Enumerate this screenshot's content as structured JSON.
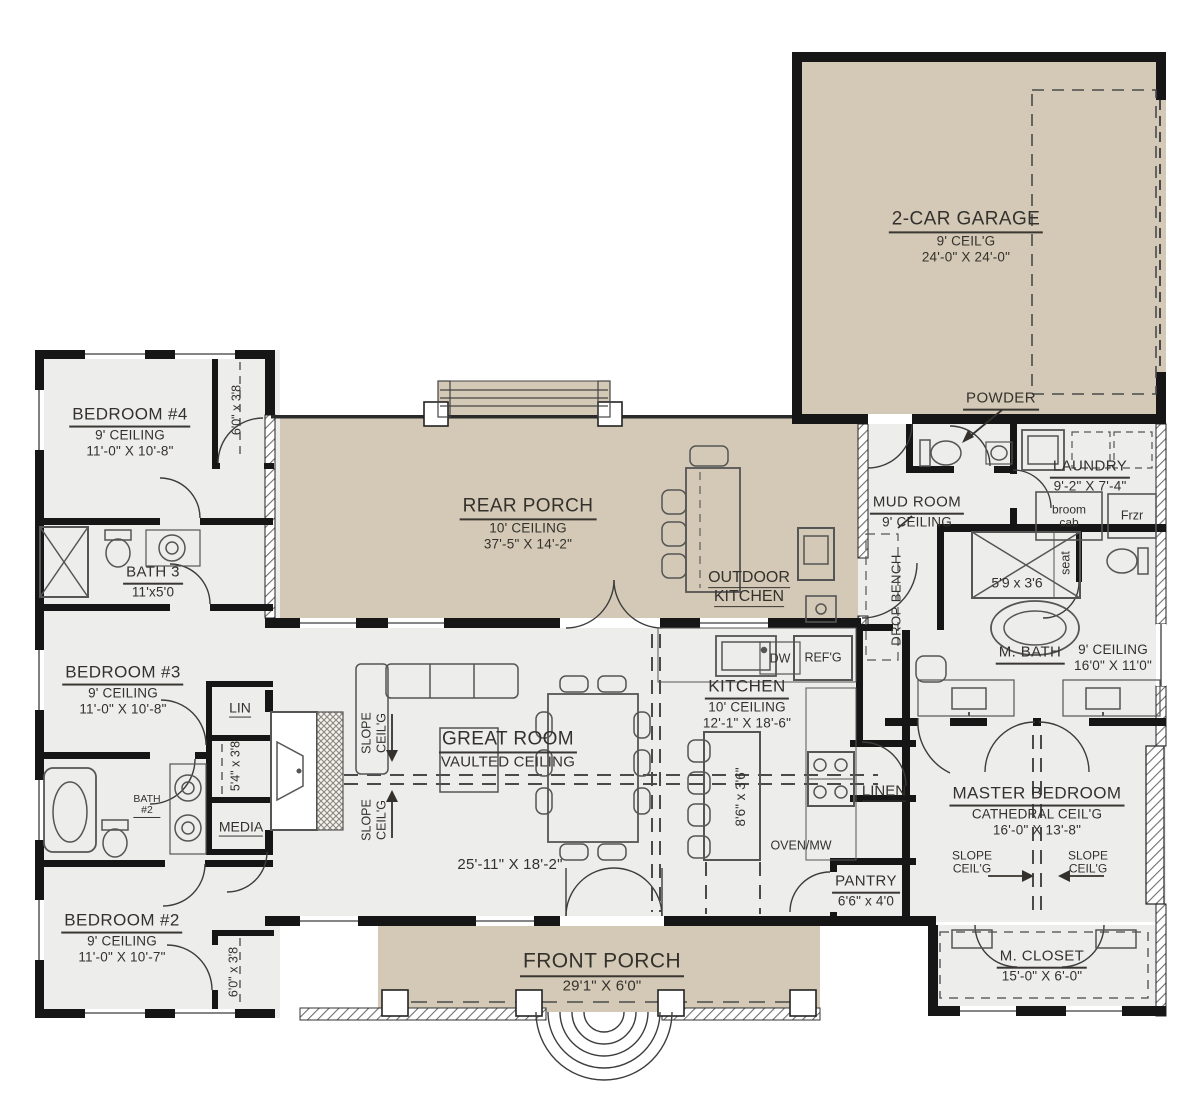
{
  "rooms": {
    "garage": {
      "name": "2-CAR GARAGE",
      "ceiling": "9' CEIL'G",
      "dims": "24'-0\" X 24'-0\""
    },
    "bedroom4": {
      "name": "BEDROOM #4",
      "ceiling": "9' CEILING",
      "dims": "11'-0\" X 10'-8\""
    },
    "rear_porch": {
      "name": "REAR PORCH",
      "ceiling": "10' CEILING",
      "dims": "37'-5\" X 14'-2\""
    },
    "outdoor_kitchen": {
      "line1": "OUTDOOR",
      "line2": "KITCHEN"
    },
    "powder": {
      "name": "POWDER"
    },
    "mud_room": {
      "name": "MUD ROOM",
      "ceiling": "9' CEILING"
    },
    "laundry": {
      "name": "LAUNDRY",
      "dims": "9'-2\" X 7'-4\""
    },
    "bath3": {
      "name": "BATH 3",
      "dims": "11'x5'0"
    },
    "bedroom3": {
      "name": "BEDROOM #3",
      "ceiling": "9' CEILING",
      "dims": "11'-0\" X 10'-8\""
    },
    "m_bath": {
      "name": "M. BATH",
      "ceiling": "9' CEILING",
      "dims": "16'0\" X 11'0\""
    },
    "kitchen": {
      "name": "KITCHEN",
      "ceiling": "10' CEILING",
      "dims": "12'-1\" X 18'-6\""
    },
    "great_room": {
      "name": "GREAT ROOM",
      "ceiling": "VAULTED CEILING",
      "dims": "25'-11\" X 18'-2\""
    },
    "master": {
      "name": "MASTER BEDROOM",
      "ceiling": "CATHEDRAL CEIL'G",
      "dims": "16'-0\" X 13'-8\""
    },
    "pantry": {
      "name": "PANTRY",
      "dims": "6'6\" x 4'0"
    },
    "bedroom2": {
      "name": "BEDROOM #2",
      "ceiling": "9' CEILING",
      "dims": "11'-0\" X 10'-7\""
    },
    "front_porch": {
      "name": "FRONT PORCH",
      "dims": "29'1\" X 6'0\""
    },
    "m_closet": {
      "name": "M. CLOSET",
      "dims": "15'-0\" X 6'-0\""
    }
  },
  "ann": {
    "lin": "LIN",
    "media": "MEDIA",
    "linen": "LINEN",
    "bath2_l1": "BATH",
    "bath2_l2": "#2",
    "dw": "DW",
    "refg": "REF'G",
    "oven_mw": "OVEN/MW",
    "drop_bench": "DROP BENCH",
    "seat": "seat",
    "shower_dims": "5'9 x 3'6",
    "island_dims": "8'6\" x 3'6\"",
    "closet4_dims": "6'0\" x 3'8",
    "closet2_dims": "6'0\" x 3'8",
    "media_closet_dims": "5'4\" x 3'8",
    "broom_l1": "broom",
    "broom_l2": "cab",
    "frzr": "Frzr",
    "slope_l1": "SLOPE",
    "slope_l2": "CEIL'G"
  },
  "colors": {
    "porch_fill": "#d3c9b6",
    "interior_fill": "#ededec",
    "wall": "#161616",
    "fixture_stroke": "#5a5a5a",
    "text": "#34312c"
  }
}
